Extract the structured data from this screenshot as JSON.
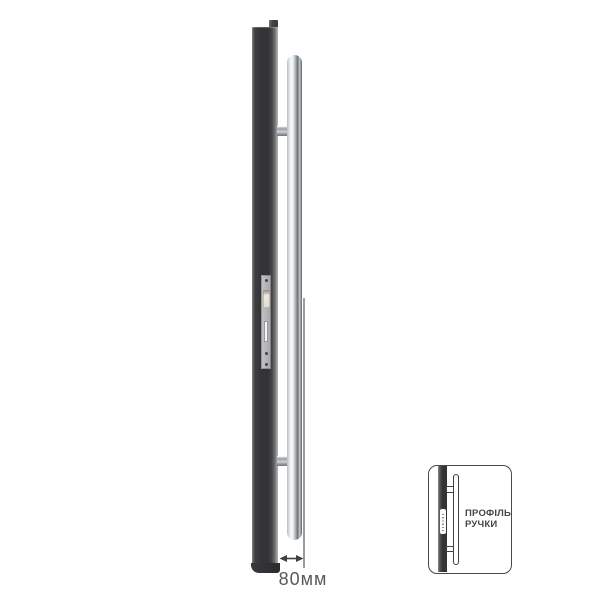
{
  "figure": {
    "background": "#ffffff",
    "door_profile_color": "#353537",
    "strike_plate_color": "#b6b8ba",
    "handle_highlight_color": "#fbfdfe",
    "handle_shadow_color": "#565a5e",
    "dimension": {
      "label": "80мм",
      "text_color": "#58595b",
      "arrow_color": "#3f4042",
      "icon": "double-headed-horizontal-arrow"
    }
  },
  "inset": {
    "title_line1": "ПРОФІЛЬ",
    "title_line2": "РУЧКИ",
    "text_color": "#45474a",
    "border_color": "#47494c",
    "profile_color": "#353537"
  }
}
